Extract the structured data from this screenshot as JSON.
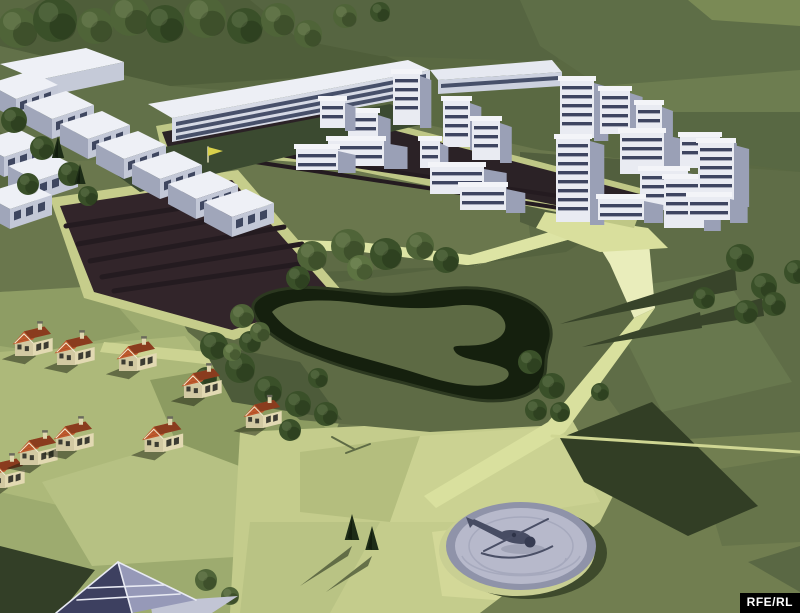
{
  "image": {
    "width": 800,
    "height": 613,
    "kind": "3d-site-rendering"
  },
  "watermark": {
    "text": "RFE/RL",
    "bg": "#000000",
    "fg": "#ffffff"
  },
  "terrain": {
    "base_polys": [
      {
        "p": "0,0 800,0 800,613 0,613",
        "f": "#6a774d"
      },
      {
        "p": "0,0 800,0 800,178 540,150 300,96 0,128",
        "f": "#5a6942"
      },
      {
        "p": "40,0 250,0 420,70 170,86 0,46 0,22",
        "f": "#4f5e3a"
      },
      {
        "p": "250,0 520,0 560,62 380,56 300,40",
        "f": "#566541"
      },
      {
        "p": "520,0 800,0 800,70 600,86 540,46",
        "f": "#5e6e47"
      },
      {
        "p": "600,86 800,70 800,112 640,112",
        "f": "#6d7d50"
      },
      {
        "p": "640,112 800,112 800,172 660,152",
        "f": "#586843"
      },
      {
        "p": "688,0 800,0 800,26 712,20",
        "f": "#7a8a55"
      },
      {
        "p": "520,152 800,172 800,432 640,442 538,302",
        "f": "#5f6d47"
      },
      {
        "p": "602,292 722,272 792,382 662,412",
        "f": "#68784e"
      },
      {
        "p": "520,152 660,162 600,252 520,222",
        "f": "#525f3e"
      },
      {
        "p": "0,292 250,284 340,420 300,530 240,613 0,613",
        "f": "#9dab6f"
      },
      {
        "p": "0,352 185,336 270,452 150,526 0,492",
        "f": "#adb97a"
      },
      {
        "p": "42,482 210,432 300,472 250,556 92,566",
        "f": "#b6c183"
      },
      {
        "p": "150,380 255,362 330,432 255,472 176,442",
        "f": "#8c9b61"
      },
      {
        "p": "0,292 100,286 140,332 40,352 0,346",
        "f": "#8e9d64"
      },
      {
        "p": "240,432 570,416 640,542 480,613 230,613",
        "f": "#c4cc8c"
      },
      {
        "p": "300,452 420,436 390,522 300,512",
        "f": "#b4be7e"
      },
      {
        "p": "420,436 560,426 600,502 470,522 390,522",
        "f": "#cbd292"
      },
      {
        "p": "250,522 380,522 330,613 240,613",
        "f": "#b9c384"
      },
      {
        "p": "432,532 560,516 520,602 442,596",
        "f": "#d3d898"
      },
      {
        "p": "640,442 800,432 800,613 480,613 600,522",
        "f": "#717e50"
      },
      {
        "p": "700,472 800,456 800,542 722,546",
        "f": "#66744a"
      },
      {
        "p": "748,562 800,546 800,592",
        "f": "#5a6844"
      },
      {
        "p": "0,46 170,86 300,96 232,152 60,162 0,132",
        "f": "#627149"
      },
      {
        "p": "0,132 60,162 30,212 0,216",
        "f": "#58673f"
      },
      {
        "p": "150,268 235,238 360,242 470,255 598,218 648,232 655,308 560,425 430,432 300,420 188,332",
        "f": "#5e6b45"
      },
      {
        "p": "150,268 235,238 360,242 470,255 598,218 604,230 474,266 362,252 240,248 160,278",
        "f": "#dde4a4"
      },
      {
        "p": "160,278 474,266 604,230 566,252 310,286 208,300",
        "f": "#55633f"
      },
      {
        "p": "598,218 648,232 655,308 634,318 610,264 588,228",
        "f": "#e9edbb"
      },
      {
        "p": "634,318 655,308 565,432 436,508 424,496 548,422",
        "f": "#d9e09e"
      },
      {
        "p": "104,342 250,356 312,398 300,410 240,368 100,352",
        "f": "#ccd392"
      },
      {
        "p": "560,438 652,402 758,506 688,536 584,482",
        "f": "#323e25"
      },
      {
        "p": "735,268 560,324 737,290",
        "f": "#38442a"
      },
      {
        "p": "762,298 622,338 764,316",
        "f": "#38442a"
      },
      {
        "p": "700,312 582,347 702,328",
        "f": "#38442a"
      },
      {
        "p": "200,342 300,362 342,420 232,402",
        "f": "#4d5b3a"
      },
      {
        "p": "545,212 648,228 668,248 600,252 536,228",
        "f": "#d9df9d"
      }
    ],
    "light_lines": [
      {
        "x1": 552,
        "y1": 436,
        "x2": 800,
        "y2": 452,
        "c": "#cfd693",
        "w": 3
      },
      {
        "x1": 332,
        "y1": 437,
        "x2": 354,
        "y2": 449,
        "c": "#5e6b45",
        "w": 2
      },
      {
        "x1": 346,
        "y1": 453,
        "x2": 370,
        "y2": 444,
        "c": "#5e6b45",
        "w": 2
      }
    ]
  },
  "fields": {
    "border_polys": [
      {
        "p": "50,198 238,170 348,298 234,340 84,298",
        "f": "#c6cd8b"
      },
      {
        "p": "156,126 302,100 648,190 634,228 324,164 162,152",
        "f": "#bfc786"
      }
    ],
    "dark_polys": [
      {
        "p": "60,206 232,180 336,298 232,330 94,292",
        "f": "#32252a"
      },
      {
        "p": "162,132 300,106 640,194 628,220 328,158 168,148",
        "f": "#2b2226"
      }
    ],
    "stripe_color": "#241b20",
    "stripes": [
      [
        66,
        226,
        252,
        197,
        5
      ],
      [
        78,
        244,
        266,
        211,
        5
      ],
      [
        90,
        261,
        284,
        227,
        5
      ],
      [
        102,
        277,
        302,
        244,
        5
      ],
      [
        114,
        291,
        320,
        261,
        5
      ],
      [
        186,
        141,
        626,
        206,
        4
      ],
      [
        176,
        150,
        612,
        216,
        4
      ]
    ]
  },
  "pond": {
    "water_path": "M253,310 C250,294 282,285 322,288 C362,291 382,297 412,293 C452,287 482,284 516,296 C546,306 556,326 549,346 C543,363 549,369 541,383 C531,399 501,404 471,399 C441,394 421,387 396,381 C371,375 341,367 316,357 C291,349 258,331 253,310 Z",
    "island_path": "M272,312 C282,300 322,298 357,303 C392,308 422,310 452,306 C482,302 502,311 505,323 C508,335 495,343 478,345 C460,347 448,343 456,353 C464,361 492,361 506,369 C513,375 506,383 489,385 C466,388 441,381 416,373 C391,365 361,358 336,350 C306,341 284,330 272,312 Z",
    "water_color": "#15200e",
    "bank_color": "#2c3820",
    "island_color": "#5d6a44"
  },
  "slab_building": {
    "shadow": {
      "p": "96,160 390,104 432,122 140,192",
      "f": "#3b4a30"
    },
    "polys": [
      {
        "p": "148,104 408,60 430,70 172,118",
        "f": "#edeff5"
      },
      {
        "p": "172,118 430,70 430,94 172,142",
        "f": "#d6dae5"
      },
      {
        "p": "176,122 426,74 426,78 176,126",
        "f": "#47506a"
      },
      {
        "p": "176,129 426,81 426,85 176,133",
        "f": "#47506a"
      },
      {
        "p": "176,136 426,88 426,92 176,140",
        "f": "#47506a"
      },
      {
        "p": "430,70 552,60 562,72 438,80",
        "f": "#e6e9f1"
      },
      {
        "p": "438,80 562,72 562,86 438,94",
        "f": "#ccd1df"
      },
      {
        "p": "441,84 558,76 558,80 441,88",
        "f": "#47506a"
      }
    ]
  },
  "campus": {
    "top_slab": [
      {
        "p": "0,64 86,48 124,62 38,80",
        "f": "#eef0f6"
      },
      {
        "p": "38,80 124,62 124,80 38,98",
        "f": "#c5cad8"
      }
    ],
    "blocks": [
      [
        -12,
        84
      ],
      [
        24,
        104
      ],
      [
        60,
        124
      ],
      [
        96,
        144
      ],
      [
        132,
        164
      ],
      [
        168,
        184
      ],
      [
        204,
        202
      ],
      [
        -24,
        142
      ],
      [
        8,
        166
      ],
      [
        -18,
        194
      ]
    ],
    "block_colors": {
      "roof": "#eef0f6",
      "front": "#c3c8d7",
      "side": "#a0a6ba",
      "window": "#3f4760"
    },
    "flag": {
      "pole": [
        208,
        162,
        208,
        147
      ],
      "flag_p": "208,147 223,151 208,156",
      "flag_f": "#d9d14b",
      "pole_c": "#e8e4c0"
    }
  },
  "towers": {
    "body": "#e9ebf2",
    "side": "#9aa0b6",
    "cap": "#f3f4f8",
    "band": "#3e4560",
    "mid": [
      [
        393,
        73,
        27,
        52
      ],
      [
        443,
        100,
        27,
        47
      ],
      [
        472,
        120,
        28,
        40
      ],
      [
        348,
        112,
        30,
        40
      ],
      [
        320,
        100,
        25,
        28
      ],
      [
        420,
        140,
        20,
        28
      ]
    ],
    "mid_podiums": [
      [
        328,
        140,
        56,
        26
      ],
      [
        430,
        166,
        54,
        28
      ],
      [
        460,
        186,
        46,
        24
      ],
      [
        296,
        148,
        42,
        22
      ]
    ],
    "right": [
      [
        560,
        80,
        34,
        58
      ],
      [
        600,
        90,
        30,
        44
      ],
      [
        636,
        104,
        26,
        36
      ],
      [
        556,
        138,
        34,
        84
      ],
      [
        620,
        132,
        44,
        42
      ],
      [
        680,
        136,
        40,
        32
      ],
      [
        640,
        170,
        48,
        40
      ],
      [
        664,
        178,
        40,
        50
      ],
      [
        698,
        142,
        36,
        62
      ]
    ],
    "right_podiums": [
      [
        688,
        196,
        42,
        24
      ],
      [
        598,
        198,
        46,
        22
      ]
    ]
  },
  "vegetation": {
    "tones": [
      "#4f6438",
      "#3a5029",
      "#5d7342"
    ],
    "round_trees": [
      [
        18,
        28,
        20,
        0
      ],
      [
        55,
        20,
        22,
        1
      ],
      [
        95,
        26,
        18,
        0
      ],
      [
        130,
        16,
        20,
        0
      ],
      [
        165,
        24,
        19,
        1
      ],
      [
        205,
        17,
        21,
        0
      ],
      [
        245,
        26,
        18,
        1
      ],
      [
        278,
        20,
        17,
        0
      ],
      [
        308,
        34,
        14,
        0
      ],
      [
        345,
        16,
        12,
        0
      ],
      [
        380,
        12,
        10,
        1
      ],
      [
        14,
        120,
        13,
        1
      ],
      [
        42,
        148,
        12,
        1
      ],
      [
        70,
        174,
        12,
        1
      ],
      [
        28,
        184,
        11,
        1
      ],
      [
        88,
        196,
        10,
        1
      ],
      [
        312,
        256,
        15,
        0
      ],
      [
        348,
        246,
        17,
        0
      ],
      [
        386,
        254,
        16,
        1
      ],
      [
        420,
        246,
        14,
        0
      ],
      [
        446,
        260,
        13,
        1
      ],
      [
        298,
        278,
        12,
        1
      ],
      [
        360,
        268,
        13,
        2
      ],
      [
        214,
        346,
        14,
        1
      ],
      [
        240,
        368,
        15,
        1
      ],
      [
        268,
        390,
        14,
        1
      ],
      [
        298,
        404,
        13,
        1
      ],
      [
        326,
        414,
        12,
        1
      ],
      [
        206,
        378,
        11,
        1
      ],
      [
        250,
        342,
        11,
        1
      ],
      [
        290,
        430,
        11,
        1
      ],
      [
        318,
        378,
        10,
        1
      ],
      [
        232,
        352,
        9,
        2
      ],
      [
        530,
        362,
        12,
        1
      ],
      [
        552,
        386,
        13,
        1
      ],
      [
        536,
        410,
        11,
        1
      ],
      [
        560,
        412,
        10,
        1
      ],
      [
        600,
        392,
        9,
        1
      ],
      [
        740,
        258,
        14,
        1
      ],
      [
        764,
        286,
        13,
        1
      ],
      [
        746,
        312,
        12,
        1
      ],
      [
        774,
        304,
        12,
        1
      ],
      [
        796,
        272,
        12,
        1
      ],
      [
        704,
        298,
        11,
        1
      ],
      [
        206,
        580,
        11,
        0
      ],
      [
        230,
        596,
        9,
        0
      ],
      [
        242,
        316,
        12,
        0
      ],
      [
        260,
        332,
        10,
        0
      ]
    ],
    "conifers": [
      [
        352,
        540,
        26
      ],
      [
        372,
        550,
        24
      ],
      [
        58,
        158,
        22
      ],
      [
        80,
        184,
        20
      ]
    ],
    "conifer_color": "#1d2c17",
    "conifer_shadows": [
      {
        "p": "352,546 300,586 348,556",
        "f": "rgba(40,52,28,0.6)"
      },
      {
        "p": "372,556 326,592 368,566",
        "f": "rgba(40,52,28,0.6)"
      }
    ]
  },
  "houses": {
    "positions": [
      [
        33,
        356,
        0.82
      ],
      [
        75,
        365,
        0.82
      ],
      [
        137,
        371,
        0.82
      ],
      [
        202,
        398,
        0.82
      ],
      [
        263,
        428,
        0.78
      ],
      [
        5,
        488,
        0.82
      ],
      [
        38,
        465,
        0.82
      ],
      [
        74,
        451,
        0.82
      ],
      [
        163,
        452,
        0.84
      ]
    ],
    "colors": {
      "wallFront": "#e2d9b2",
      "wallSide": "#d2c9a2",
      "roofBright": "#c05a2e",
      "roofDark": "#8a3c1e",
      "trim": "#f0ead0",
      "window": "#3c3c32",
      "chimney": "#ded5ae",
      "chimneyCap": "#6a6a5c",
      "shadow": "rgba(25,32,16,0.5)",
      "tile": "#a84e27"
    }
  },
  "pyramid": {
    "shadow": {
      "p": "0,546 95,570 60,613 0,613",
      "f": "#333f27"
    },
    "skirt": {
      "p": "150,602 238,596 212,613 152,613",
      "f": "#c2c5d5"
    },
    "left_face": {
      "p": "118,562 56,613 132,613",
      "f": "#3d4060"
    },
    "right_face": {
      "p": "118,562 132,613 196,600",
      "f": "#9699b8"
    },
    "rib_color": "#e8eaf3",
    "ribs": [
      [
        118,
        562,
        56,
        613
      ],
      [
        118,
        562,
        132,
        613
      ],
      [
        118,
        562,
        196,
        600
      ],
      [
        88,
        588,
        164,
        585
      ],
      [
        77,
        600,
        180,
        594
      ]
    ]
  },
  "helipad": {
    "cx": 521,
    "cy": 546,
    "shadow": "#3e4a2c",
    "rim_lit": "#c9cf93",
    "rim": "#8f93a9",
    "pad": "#b7b9cb",
    "ring": "#a6a9bd",
    "wash_arcs": [
      "M462,556 a60,24 0 0 0 118,0",
      "M478,562 a45,17 0 0 0 88,-4"
    ]
  },
  "helicopter": {
    "body": "#474c63",
    "dark": "#363b52",
    "blade": "#4a4f66",
    "hub": "#2e3348",
    "ground_shadow": "#8e92a6",
    "tail_p": "470,523 474,519 509,535 505,541",
    "fin_p": "466,517 476,521 470,528"
  }
}
